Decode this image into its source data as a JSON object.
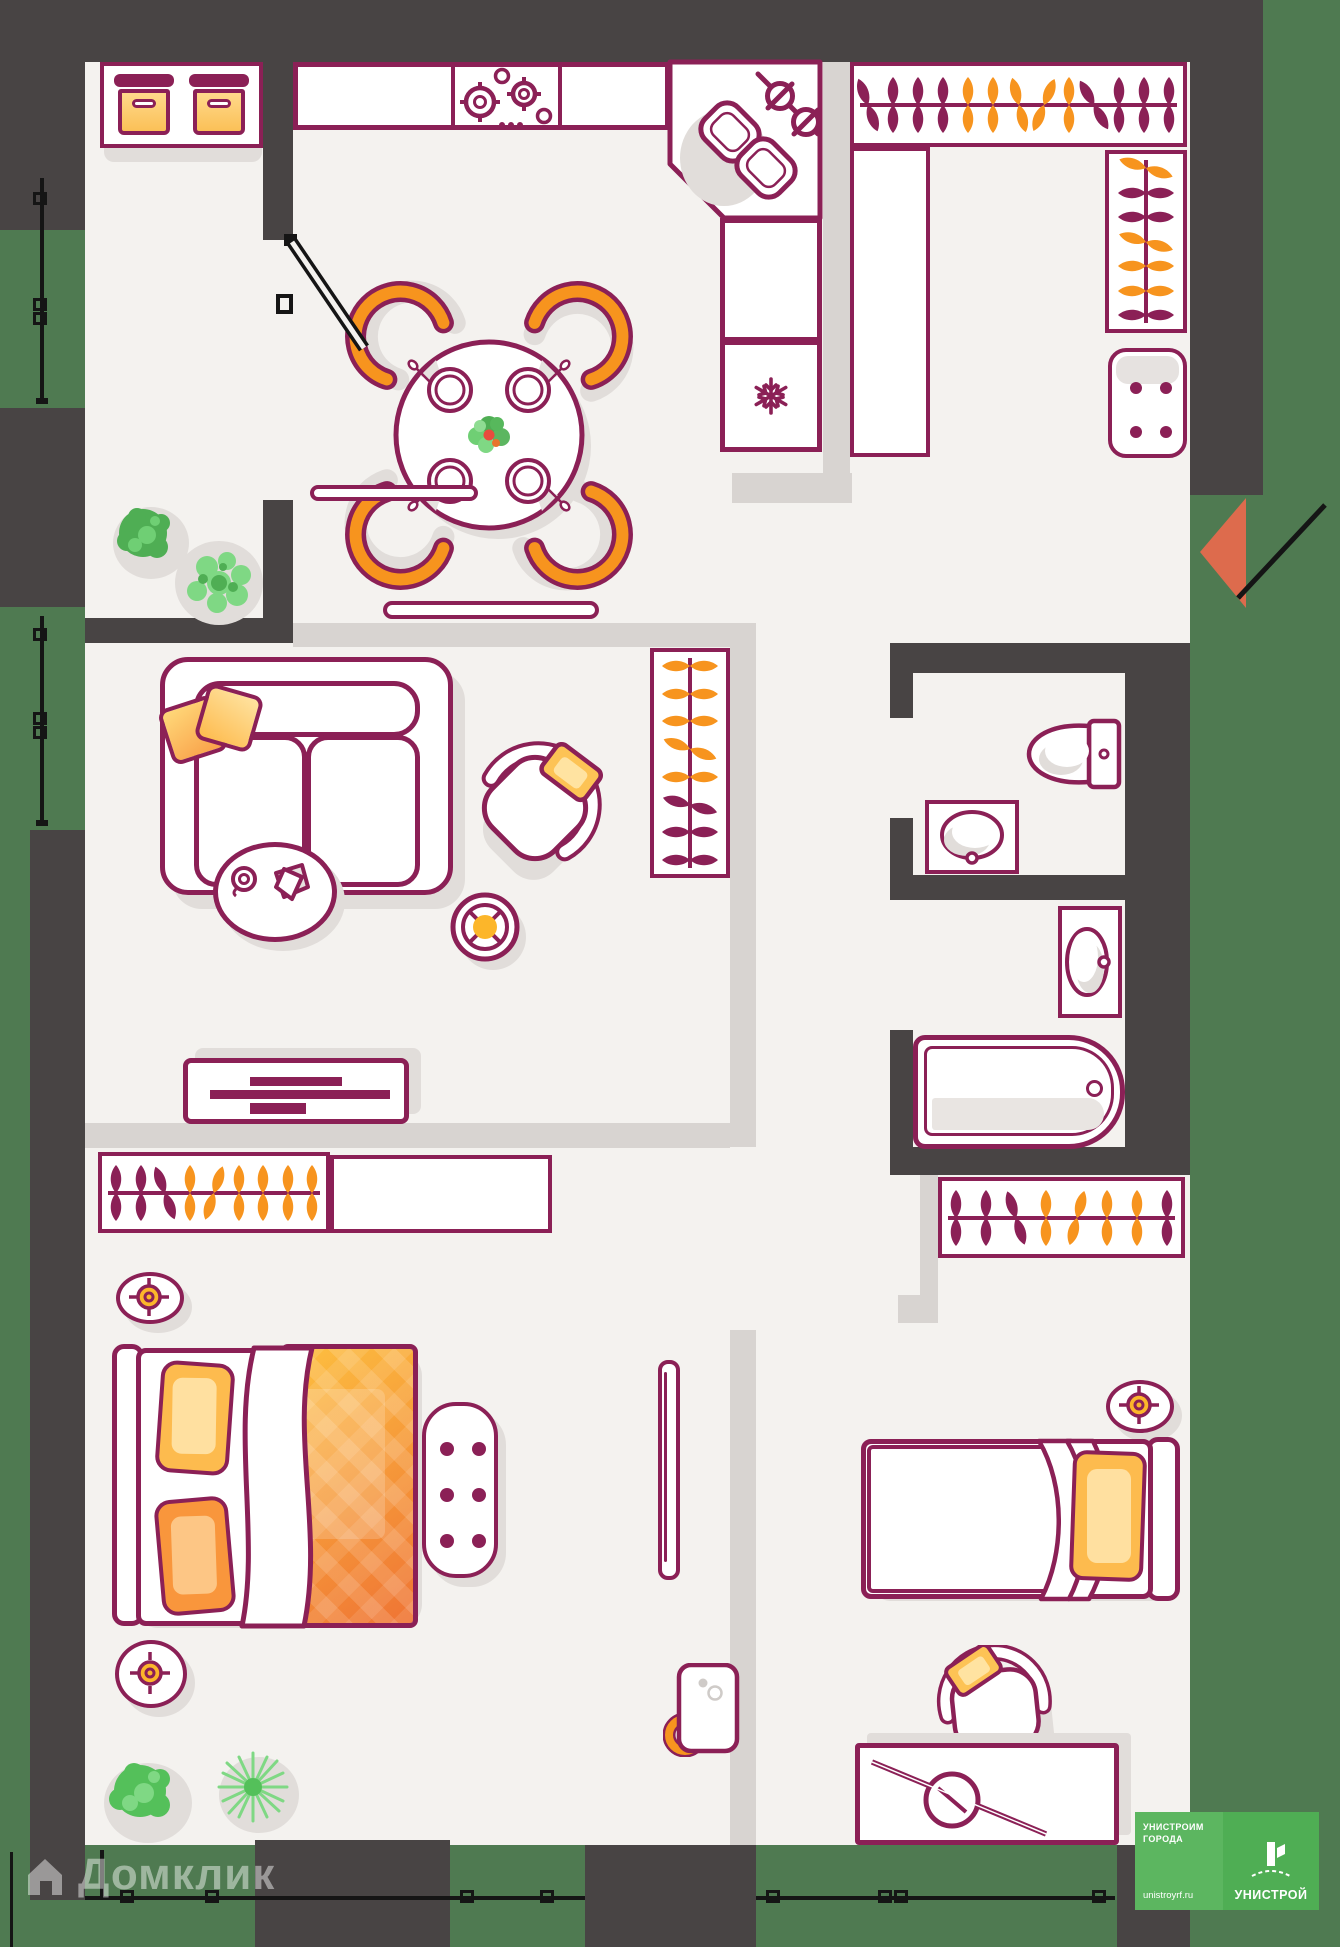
{
  "watermark": {
    "brand": "Домклик"
  },
  "developer_logo": {
    "tagline_line1": "УНИСТРОИМ",
    "tagline_line2": "ГОРОДА",
    "website": "unistroyrf.ru",
    "brand": "УНИСТРОЙ"
  },
  "palette": {
    "wall": "#484444",
    "outdoor_green": "#4f7a51",
    "floor": "#f4f2ef",
    "partition": "#d8d4d1",
    "outline_maroon": "#8b2056",
    "accent_orange": "#f7941e",
    "pillow_yellow": "#fdbb4e",
    "blanket_orange": "#ef7434",
    "door_marker": "#dd6b4d",
    "lamp_yellow": "#fcb62a",
    "shadow": "#e1ddda",
    "logo_green_left": "#5cb660",
    "logo_green_right": "#4fae54"
  },
  "wardrobes": {
    "entry_top": {
      "rail": "h",
      "colors": [
        "maroon",
        "maroon",
        "maroon",
        "maroon",
        "orange",
        "orange",
        "orange",
        "orange",
        "orange",
        "maroon",
        "maroon",
        "maroon",
        "maroon"
      ],
      "tilts": [
        -20,
        0,
        0,
        0,
        0,
        0,
        -14,
        22,
        0,
        -30,
        0,
        0,
        0
      ]
    },
    "entry_side": {
      "rail": "v",
      "colors": [
        "orange",
        "maroon",
        "maroon",
        "orange",
        "orange",
        "orange",
        "maroon"
      ],
      "tilts": [
        18,
        0,
        0,
        16,
        0,
        0,
        0
      ]
    },
    "living_room": {
      "rail": "v",
      "colors": [
        "orange",
        "orange",
        "orange",
        "orange",
        "orange",
        "maroon",
        "maroon",
        "maroon"
      ],
      "tilts": [
        0,
        0,
        0,
        20,
        0,
        15,
        0,
        0
      ]
    },
    "bedroom_1": {
      "rail": "h",
      "colors": [
        "maroon",
        "maroon",
        "maroon",
        "orange",
        "orange",
        "orange",
        "orange",
        "orange",
        "orange"
      ],
      "tilts": [
        0,
        0,
        -20,
        0,
        18,
        0,
        0,
        0,
        0
      ]
    },
    "bedroom_2": {
      "rail": "h",
      "colors": [
        "maroon",
        "maroon",
        "maroon",
        "orange",
        "orange",
        "orange",
        "orange",
        "maroon"
      ],
      "tilts": [
        0,
        0,
        -18,
        0,
        15,
        0,
        0,
        0
      ]
    }
  }
}
